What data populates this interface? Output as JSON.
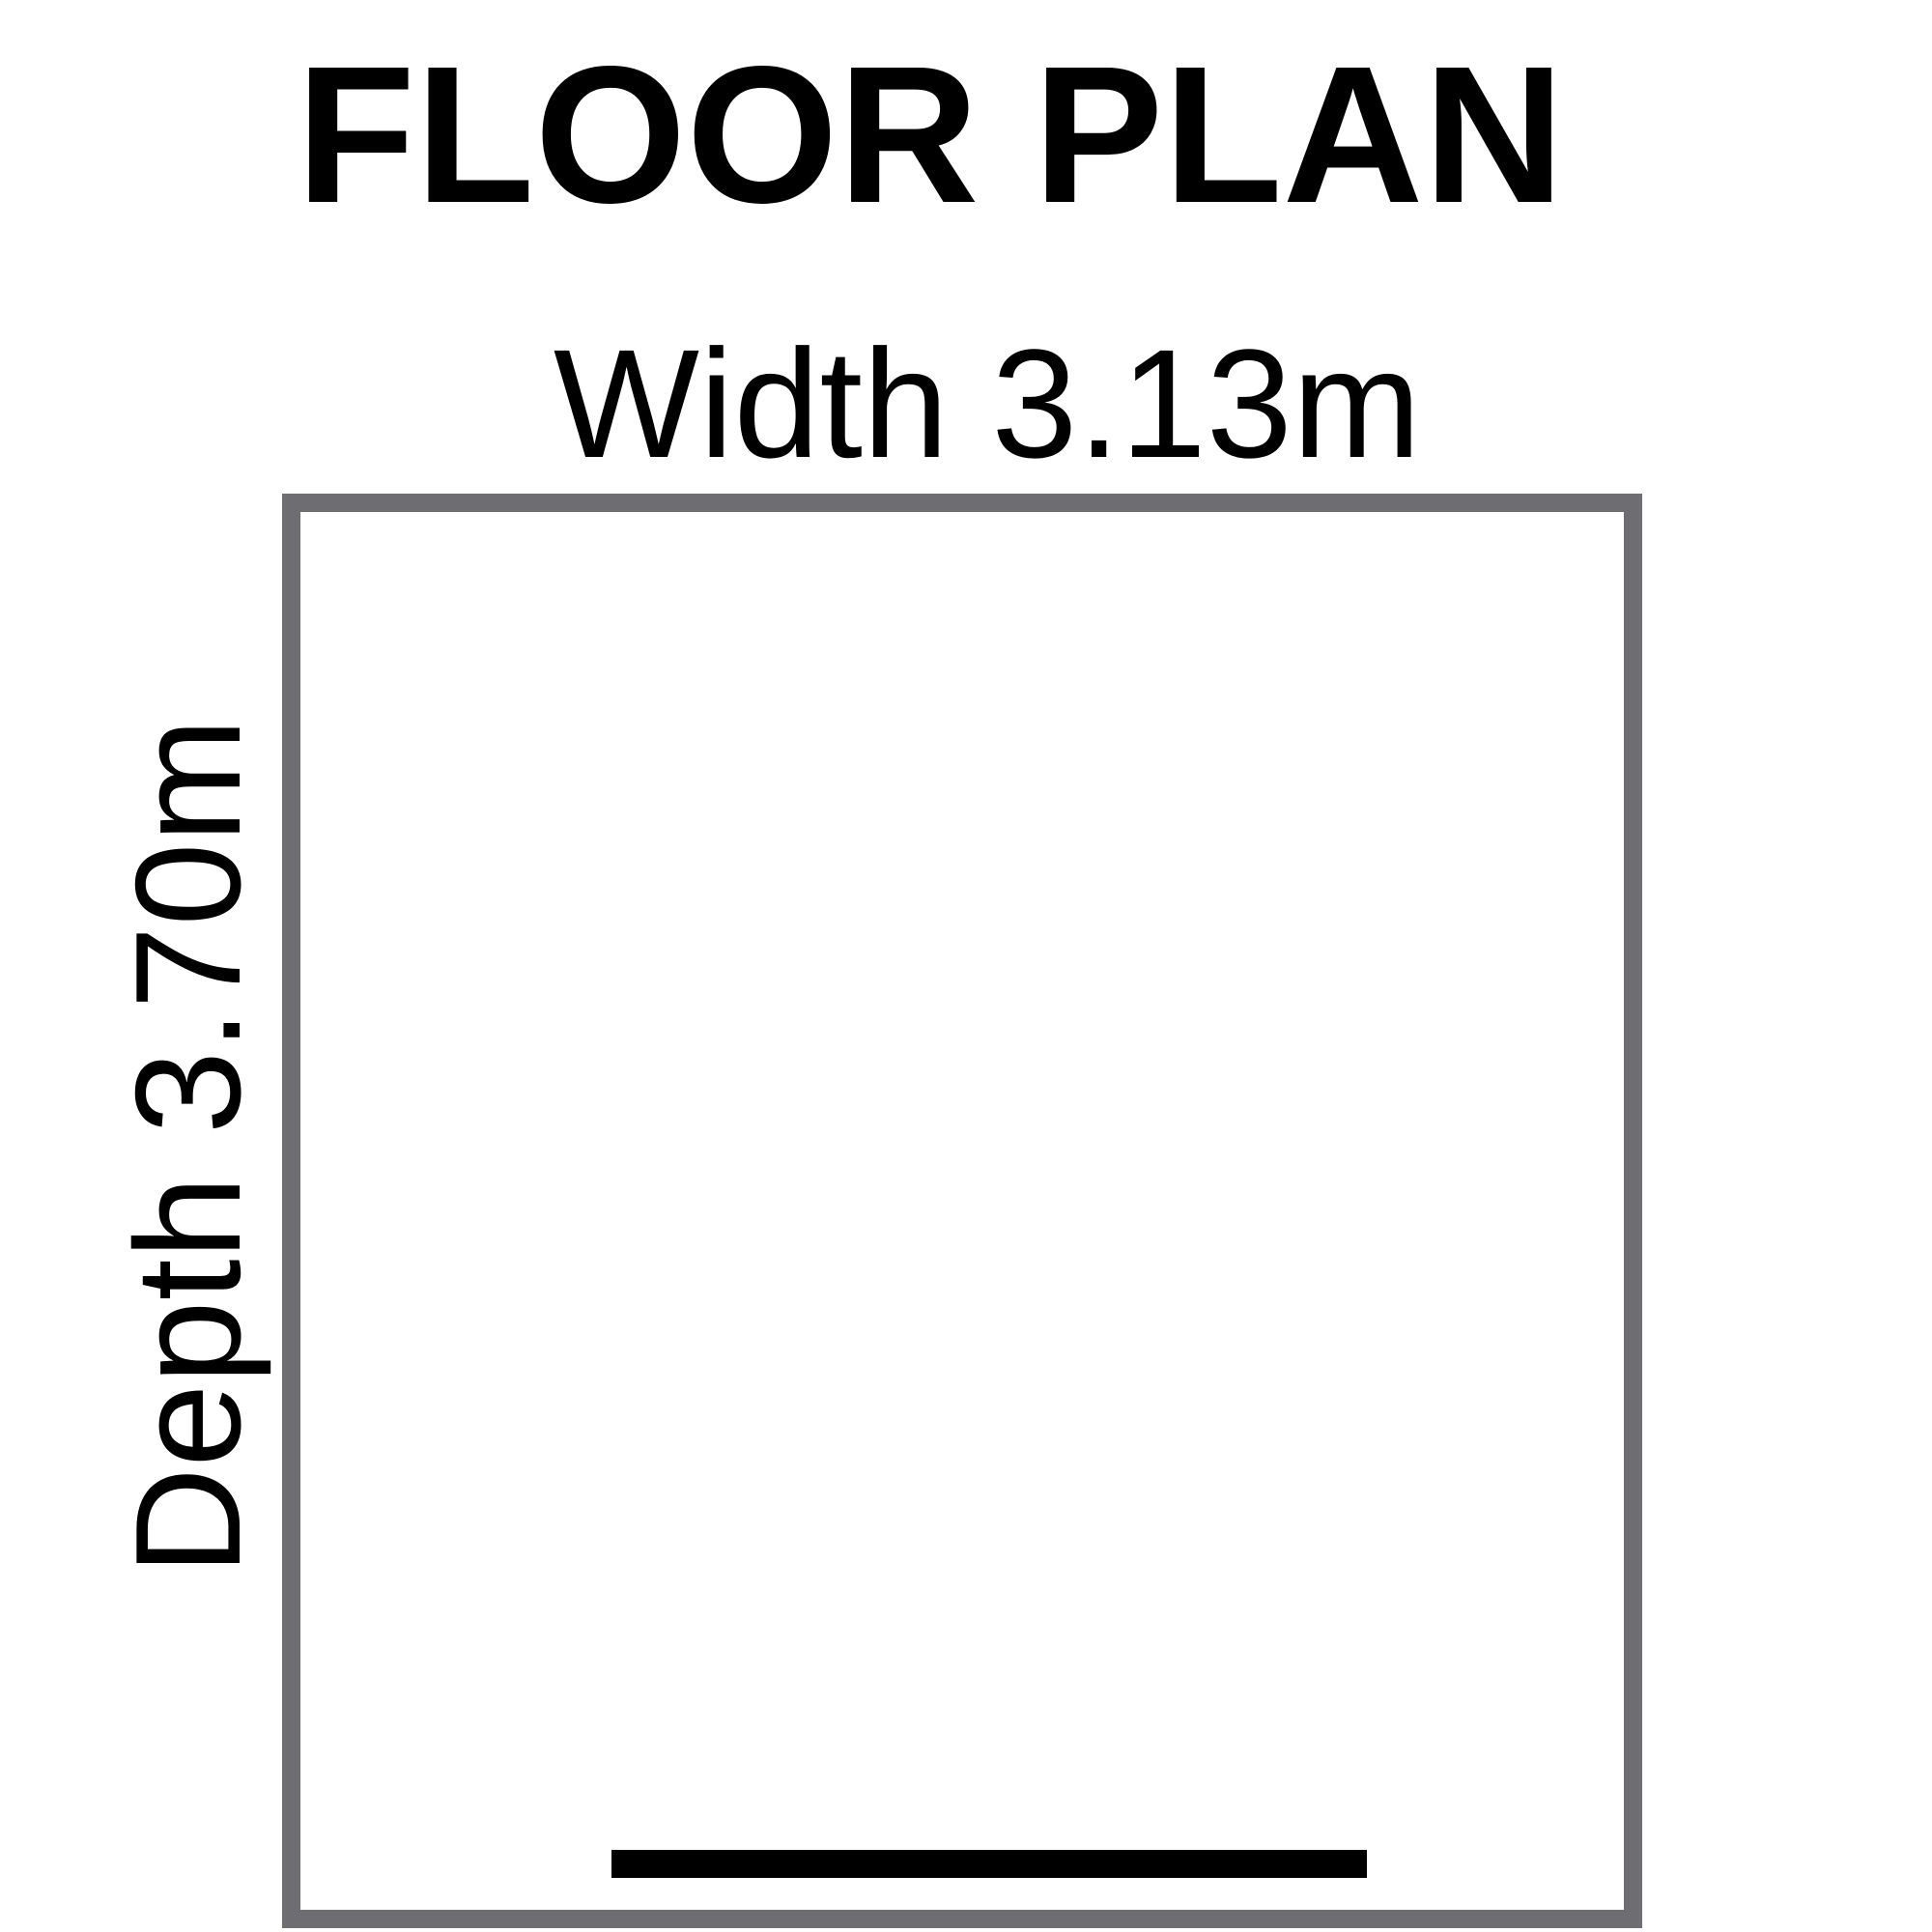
{
  "title": {
    "text": "FLOOR PLAN"
  },
  "dimensions": {
    "width_label": "Width 3.13m",
    "depth_label": "Depth 3.70m",
    "width_value": "3.13m",
    "depth_value": "3.70m"
  },
  "room": {
    "outline_color": "#6d6d72",
    "fill": "#ffffff"
  },
  "scale_bar": {
    "color": "#000000"
  },
  "colors": {
    "text": "#000000",
    "background": "#ffffff"
  }
}
